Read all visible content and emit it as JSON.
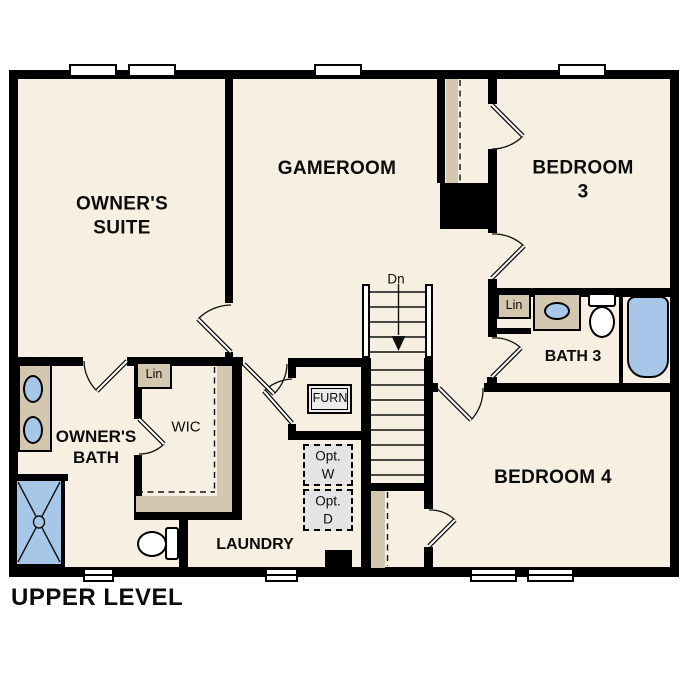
{
  "title": "UPPER LEVEL",
  "labels": {
    "owners_suite": "OWNER'S\nSUITE",
    "gameroom": "GAMEROOM",
    "bedroom3": "BEDROOM 3",
    "bedroom4": "BEDROOM 4",
    "owners_bath": "OWNER'S\nBATH",
    "wic": "WIC",
    "laundry": "LAUNDRY",
    "bath3": "BATH 3",
    "furnace": "FURN",
    "linen_owners": "Lin",
    "linen_bath3": "Lin",
    "stairs_down": "Dn",
    "opt_washer": "Opt.\nW",
    "opt_dryer": "Opt.\nD",
    "level": "UPPER LEVEL"
  },
  "colors": {
    "background": "#ffffff",
    "floor": "#f7efe2",
    "wall": "#000000",
    "casework_tan": "#d4c7b0",
    "fixture_blue": "#a6c7e7",
    "appliance_gray": "#e4e4e4"
  }
}
